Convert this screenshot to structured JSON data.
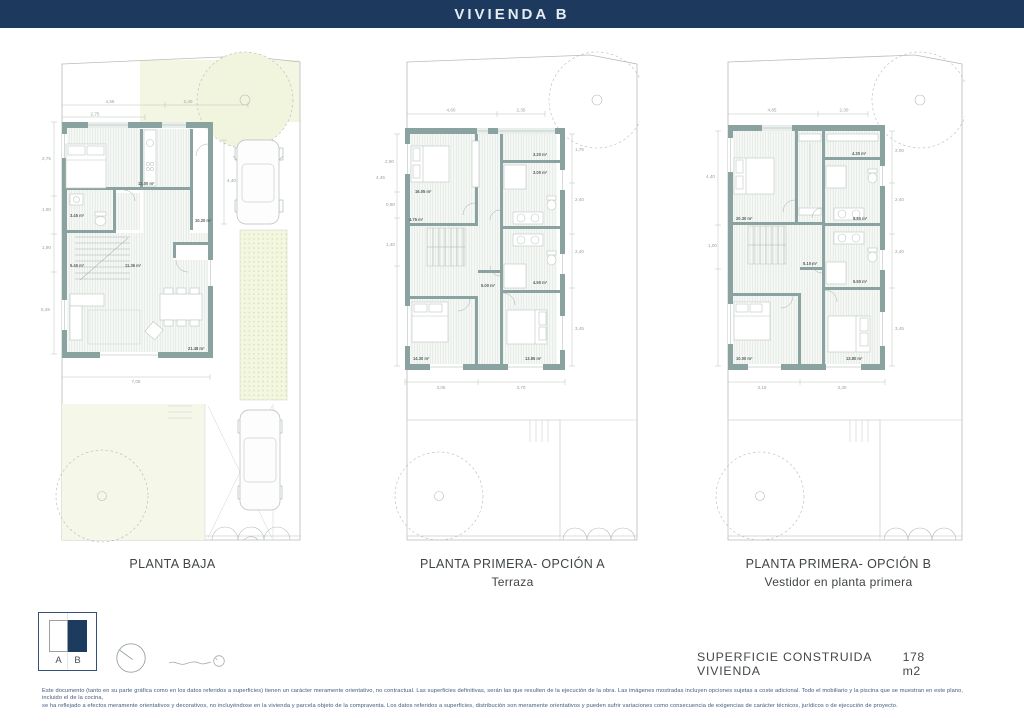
{
  "header": {
    "title": "VIVIENDA B"
  },
  "plans": [
    {
      "title": "PLANTA BAJA",
      "subtitle": "",
      "dims": {
        "top1": "4,55",
        "top2": "2,40",
        "top3": "2,75",
        "left1": "2,75",
        "left2": "1,90",
        "left3": "1,90",
        "left4": "5,45",
        "right1": "4,40",
        "bottom1": "7,05"
      },
      "rooms": {
        "r1": "12.00 m²",
        "r2": "3.45 m²",
        "r3": "10.20 m²",
        "r4": "5.40 m²",
        "r5": "11.36 m²",
        "r6": "21.48 m²"
      }
    },
    {
      "title": "PLANTA PRIMERA- OPCIÓN A",
      "subtitle": "Terraza",
      "dims": {
        "top1": "4,60",
        "top2": "2,35",
        "left1": "2,90",
        "left2": "4,45",
        "left3": "0,90",
        "left4": "1,40",
        "right1": "1,75",
        "right2": "2,40",
        "right3": "2,40",
        "right4": "3,45",
        "bottom1": "3,05",
        "bottom2": "3,70"
      },
      "rooms": {
        "r1": "16.05 m²",
        "r2": "4.75 m²",
        "r3": "3.20 m²",
        "r4": "3.00 m²",
        "r5": "4.50 m²",
        "r6": "5.00 m²",
        "r7": "14.30 m²",
        "r8": "13.85 m²"
      }
    },
    {
      "title": "PLANTA PRIMERA- OPCIÓN B",
      "subtitle": "Vestidor en planta primera",
      "dims": {
        "top1": "4,85",
        "top2": "2,30",
        "left1": "4,40",
        "left2": "1,00",
        "right1": "2,00",
        "right2": "2,40",
        "right3": "2,40",
        "right4": "3,45",
        "bottom1": "3,15",
        "bottom2": "3,30"
      },
      "rooms": {
        "r1": "20.30 m²",
        "r2": "4.30 m²",
        "r3": "5.50 m²",
        "r4": "5.10 m²",
        "r5": "5.50 m²",
        "r6": "10.00 m²",
        "r7": "13.80 m²"
      }
    }
  ],
  "legend": {
    "option_a": "A",
    "option_b": "B",
    "icons": [
      "compass-icon",
      "scale-indicator-icon"
    ]
  },
  "summary": {
    "label": "SUPERFICIE CONSTRUIDA VIVIENDA",
    "value": "178 m2"
  },
  "disclaimer": {
    "line1": "Este documento (tanto en su parte gráfica como en los datos referidos a superficies) tienen un carácter meramente orientativo, no contractual. Las superficies definitivas, serán las que resulten de la ejecución de la obra. Las imágenes mostradas incluyen opciones sujetas a coste adicional. Todo el mobiliario y la piscina que se muestran en este plano, incluido el de la cocina,",
    "line2": "se ha reflejado a efectos meramente orientativos y decorativos, no incluyéndose en la vivienda y parcela objeto de la compraventa. Los datos referidos a superficies, distribución son meramente orientativos y pueden sufrir variaciones como consecuencia de exigencias de carácter técnicos, jurídicos o de ejecución de proyecto."
  },
  "colors": {
    "header_bg": "#1d3a5e",
    "wall": "#8ba3a0",
    "garden": "#f4f6e6",
    "accent_navy": "#1d3a5f"
  }
}
